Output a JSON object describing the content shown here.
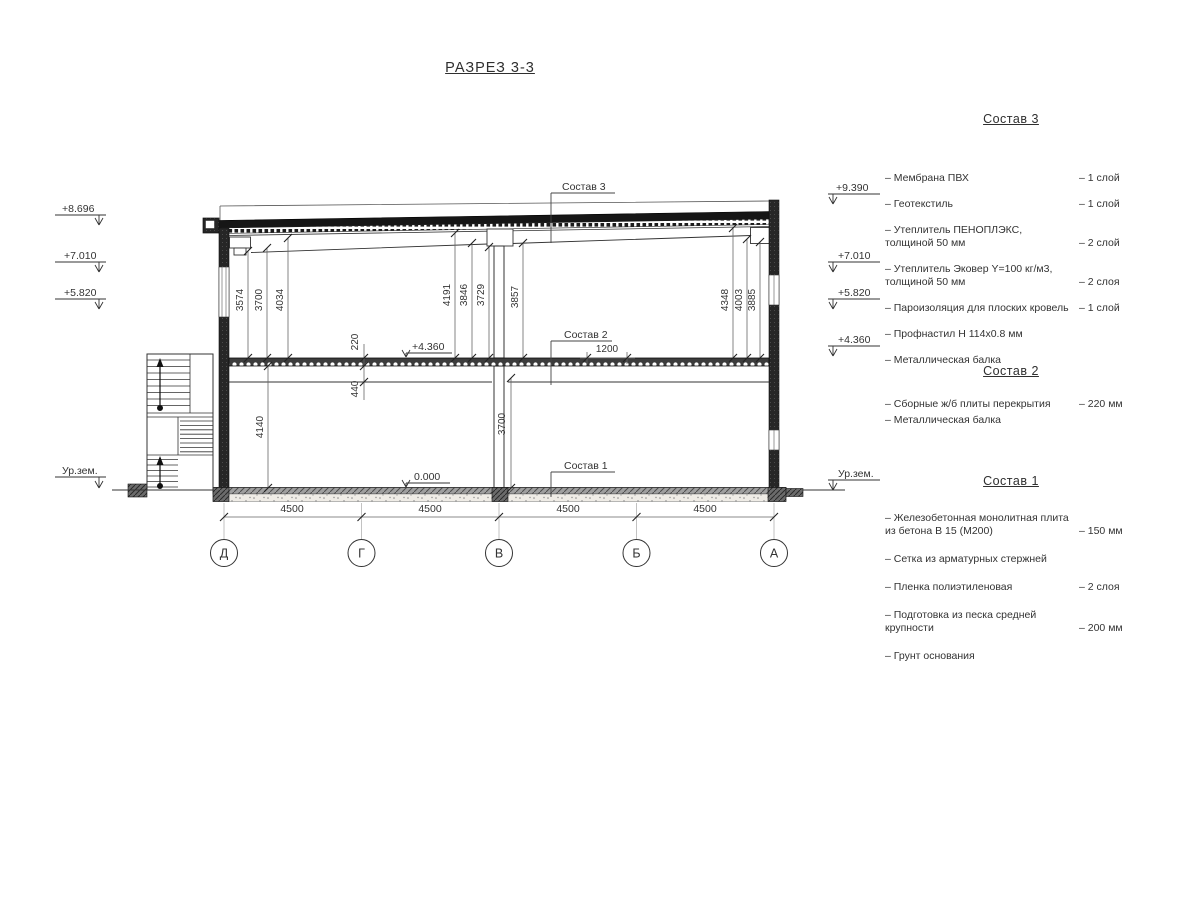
{
  "title": "РАЗРЕЗ 3-3",
  "section": {
    "elev_left": [
      "+8.696",
      "+7.010",
      "+5.820",
      "Ур.зем."
    ],
    "elev_right": [
      "+9.390",
      "+7.010",
      "+5.820",
      "+4.360",
      "Ур.зем."
    ],
    "marks": {
      "zero": "0.000",
      "second_floor": "+4.360"
    },
    "callouts": {
      "c3": "Состав 3",
      "c2": "Состав 2",
      "c1": "Состав 1"
    },
    "dims": {
      "upper_left": [
        "3574",
        "3700",
        "4034"
      ],
      "upper_mid": [
        "4191",
        "3846",
        "3729"
      ],
      "upper_mid_right": "3857",
      "upper_right": [
        "4348",
        "4003",
        "3885"
      ],
      "ground_left": "4140",
      "slab_thickness": "220",
      "beam_depth": "440",
      "ground_right": "3700",
      "opening": "1200",
      "spans": [
        "4500",
        "4500",
        "4500",
        "4500"
      ]
    },
    "axes": [
      "Д",
      "Г",
      "В",
      "Б",
      "А"
    ]
  },
  "legend": {
    "sections": [
      {
        "heading": "Состав 3",
        "items": [
          {
            "name": "– Мембрана ПВХ",
            "qty": "– 1 слой"
          },
          {
            "name": "– Геотекстиль",
            "qty": "– 1 слой"
          },
          {
            "name": "– Утеплитель ПЕНОПЛЭКС,\nтолщиной 50 мм",
            "qty": "– 2 слой"
          },
          {
            "name": "– Утеплитель Эковер Y=100 кг/м3,\nтолщиной 50 мм",
            "qty": "– 2 слоя"
          },
          {
            "name": "– Пароизоляция для плоских кровель",
            "qty": "– 1 слой"
          },
          {
            "name": "– Профнастил Н 114х0.8 мм",
            "qty": ""
          },
          {
            "name": "– Металлическая балка",
            "qty": ""
          }
        ]
      },
      {
        "heading": "Состав 2",
        "items": [
          {
            "name": "– Сборные ж/б плиты перекрытия",
            "qty": "– 220 мм"
          },
          {
            "name": "– Металлическая балка",
            "qty": ""
          }
        ]
      },
      {
        "heading": "Состав 1",
        "items": [
          {
            "name": "– Железобетонная  монолитная плита\nиз бетона В 15 (М200)",
            "qty": "– 150 мм"
          },
          {
            "name": "– Сетка из арматурных стержней",
            "qty": ""
          },
          {
            "name": "– Пленка полиэтиленовая",
            "qty": "–  2 слоя"
          },
          {
            "name": "– Подготовка из песка средней\nкрупности",
            "qty": "– 200 мм"
          },
          {
            "name": "– Грунт основания",
            "qty": ""
          }
        ]
      }
    ]
  }
}
